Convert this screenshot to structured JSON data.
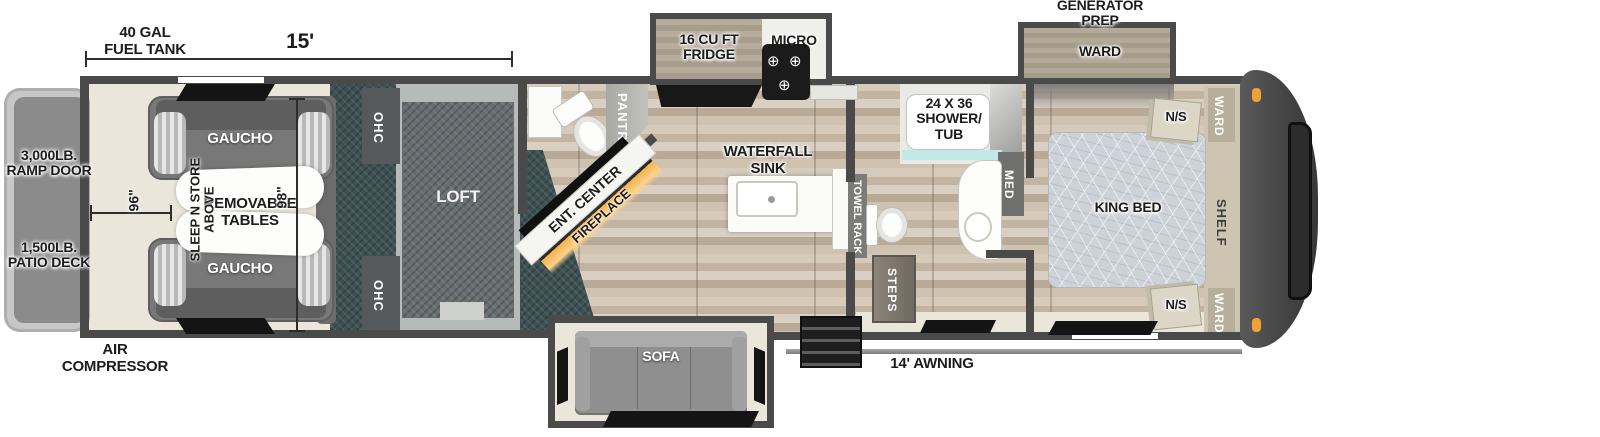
{
  "meta": {
    "title": "Fifth-wheel toy hauler floor plan",
    "canvas": "1600x437"
  },
  "colors": {
    "wall": "#4a4a4a",
    "carpet": "#3d5153",
    "cream_floor": "#eae6da",
    "wood_floor": "#cdc0af",
    "loft_gray": "#676d70",
    "front_cap": "#4c4c4c",
    "marker_light": "#f2a235",
    "fireplace_glow": "#f7b04a"
  },
  "icons": {
    "burner": "⊕"
  },
  "dimensions": {
    "fuel_tank": "40 GAL\nFUEL TANK",
    "garage_length": "15'",
    "garage_width": "96\"",
    "garage_depth": "98\"",
    "awning": "14' AWNING"
  },
  "exterior": {
    "ramp_door": "3,000LB.\nRAMP DOOR",
    "patio_deck": "1,500LB.\nPATIO DECK",
    "air_compressor": "AIR\nCOMPRESSOR",
    "generator_prep": "GENERATOR\nPREP"
  },
  "garage": {
    "gaucho_top": "GAUCHO",
    "gaucho_bottom": "GAUCHO",
    "removable_tables": "REMOVABLE\nTABLES",
    "sleep_n_store": "SLEEP N STORE\nABOVE",
    "ohc_top": "OHC",
    "ohc_bottom": "OHC",
    "loft": "LOFT"
  },
  "living": {
    "ent_center": "ENT. CENTER",
    "fireplace": "FIREPLACE",
    "pantry": "PANTRY",
    "sofa": "SOFA"
  },
  "kitchen": {
    "fridge": "16 CU FT\nFRIDGE",
    "micro": "MICRO",
    "sink": "WATERFALL\nSINK"
  },
  "bath": {
    "shower": "24 X 36\nSHOWER/\nTUB",
    "med": "MED",
    "towel_rack": "TOWEL RACK",
    "steps": "STEPS"
  },
  "bedroom": {
    "king_bed": "KING BED",
    "shelf": "SHELF",
    "ward_slide": "WARD",
    "ward_top": "WARD",
    "ward_bottom": "WARD",
    "ns_top": "N/S",
    "ns_bottom": "N/S"
  }
}
